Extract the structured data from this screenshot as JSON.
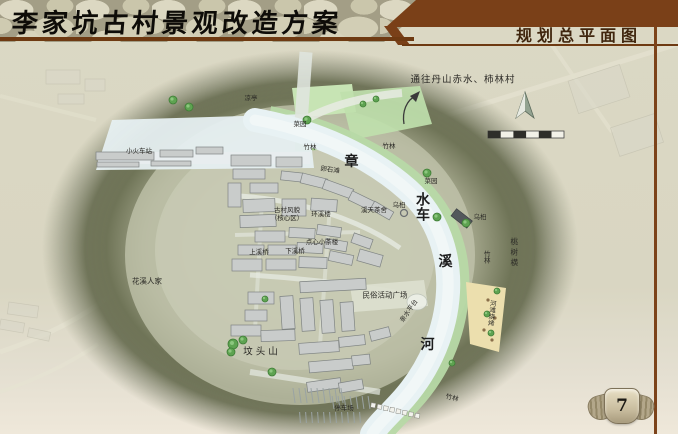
{
  "slide": {
    "title": "李家坑古村景观改造方案",
    "section_title": "规划总平面图",
    "page_number": "7"
  },
  "map": {
    "route_sign": "通往丹山赤水、柿林村",
    "river_name": "章溪河",
    "labels": [
      {
        "text": "通往丹山赤水、柿林村",
        "x": 463,
        "y": 80,
        "size": "md"
      },
      {
        "text": "小火车站",
        "x": 139,
        "y": 151,
        "size": "xs"
      },
      {
        "text": "凉亭",
        "x": 251,
        "y": 98,
        "size": "xs"
      },
      {
        "text": "菜园",
        "x": 300,
        "y": 124,
        "size": "xs"
      },
      {
        "text": "竹林",
        "x": 310,
        "y": 147,
        "size": "xs"
      },
      {
        "text": "竹林",
        "x": 389,
        "y": 146,
        "size": "xs"
      },
      {
        "text": "卵石滩",
        "x": 330,
        "y": 170,
        "size": "xs",
        "rot": 8
      },
      {
        "text": "章",
        "x": 352,
        "y": 162,
        "size": "lg"
      },
      {
        "text": "溪天茶舍",
        "x": 374,
        "y": 210,
        "size": "xs"
      },
      {
        "text": "乌桕",
        "x": 399,
        "y": 205,
        "size": "xs"
      },
      {
        "text": "菜园",
        "x": 431,
        "y": 181,
        "size": "xs"
      },
      {
        "text": "水车",
        "x": 422,
        "y": 207,
        "size": "lg",
        "vertical": true
      },
      {
        "text": "乌桕",
        "x": 480,
        "y": 217,
        "size": "xs"
      },
      {
        "text": "溪",
        "x": 446,
        "y": 262,
        "size": "lg"
      },
      {
        "text": "竹林",
        "x": 486,
        "y": 257,
        "size": "xs",
        "vertical": true
      },
      {
        "text": "桃树横",
        "x": 514,
        "y": 253,
        "size": "sm",
        "vertical": true,
        "spaced": true
      },
      {
        "text": "古村风貌",
        "x": 287,
        "y": 210,
        "size": "xs"
      },
      {
        "text": "（核心区）",
        "x": 287,
        "y": 218,
        "size": "xs"
      },
      {
        "text": "环溪楼",
        "x": 321,
        "y": 214,
        "size": "xs"
      },
      {
        "text": "点心小茶楼",
        "x": 322,
        "y": 242,
        "size": "xs"
      },
      {
        "text": "上溪桥",
        "x": 259,
        "y": 252,
        "size": "xs"
      },
      {
        "text": "下溪桥",
        "x": 295,
        "y": 251,
        "size": "xs"
      },
      {
        "text": "花溪人家",
        "x": 147,
        "y": 281,
        "size": "sm"
      },
      {
        "text": "民俗活动广场",
        "x": 385,
        "y": 295,
        "size": "sm"
      },
      {
        "text": "亲水平台",
        "x": 409,
        "y": 311,
        "size": "xs",
        "rot": -55
      },
      {
        "text": "河滩烧烤",
        "x": 491,
        "y": 313,
        "size": "xs",
        "vertical": true,
        "rot": 6
      },
      {
        "text": "坟头山",
        "x": 262,
        "y": 352,
        "size": "md",
        "spaced": true
      },
      {
        "text": "河",
        "x": 428,
        "y": 345,
        "size": "lg"
      },
      {
        "text": "停车场",
        "x": 344,
        "y": 408,
        "size": "xs"
      },
      {
        "text": "竹林",
        "x": 452,
        "y": 398,
        "size": "xs",
        "rot": 14
      }
    ],
    "icons": [
      "north-arrow-icon",
      "scale-bar",
      "route-arrow-icon",
      "page-emblem"
    ],
    "colors": {
      "accent_brown": "#7a4018",
      "water": "#e8f2f4",
      "vegetation": "#b7d9a6",
      "sand": "#ecdfae",
      "building_fill": "#c9cccb",
      "site_shadow": "#676c50",
      "page_bg": "#dbd8c4"
    }
  }
}
